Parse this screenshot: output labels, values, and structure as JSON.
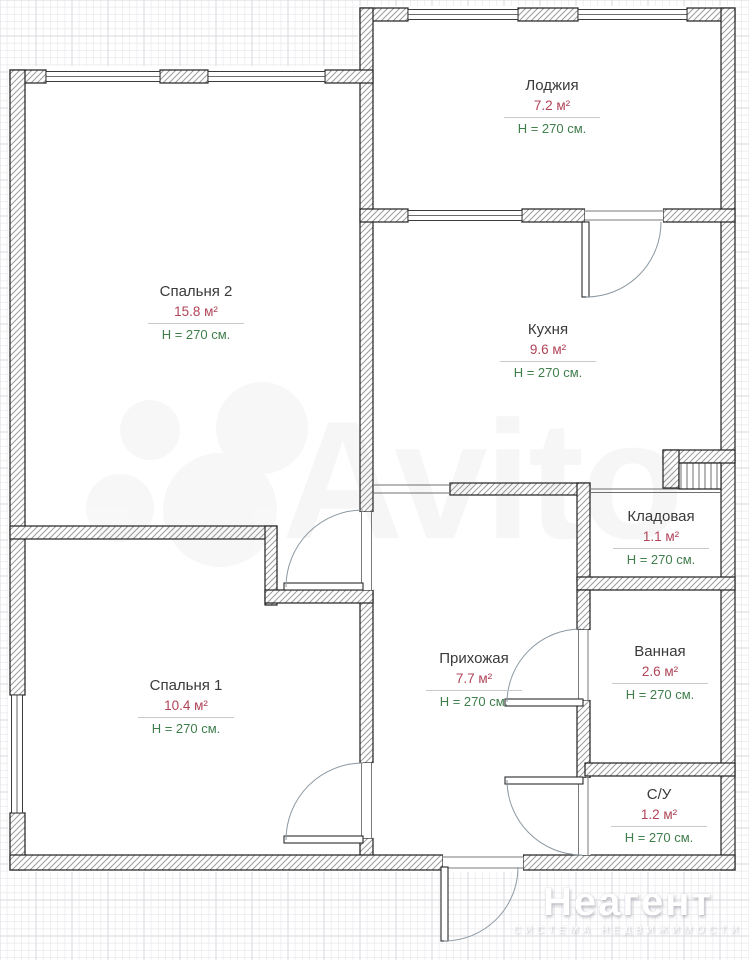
{
  "rooms": [
    {
      "id": "lodzhiya",
      "name": "Лоджия",
      "area": "7.2 м²",
      "height": "H = 270 см."
    },
    {
      "id": "spalnya2",
      "name": "Спальня 2",
      "area": "15.8 м²",
      "height": "H = 270 см."
    },
    {
      "id": "kuhnya",
      "name": "Кухня",
      "area": "9.6 м²",
      "height": "H = 270 см."
    },
    {
      "id": "kladovaya",
      "name": "Кладовая",
      "area": "1.1 м²",
      "height": "H = 270 см."
    },
    {
      "id": "prihozhaya",
      "name": "Прихожая",
      "area": "7.7 м²",
      "height": "H = 270 см."
    },
    {
      "id": "vannaya",
      "name": "Ванная",
      "area": "2.6 м²",
      "height": "H = 270 см."
    },
    {
      "id": "spalnya1",
      "name": "Спальня 1",
      "area": "10.4 м²",
      "height": "H = 270 см."
    },
    {
      "id": "su",
      "name": "С/У",
      "area": "1.2 м²",
      "height": "H = 270 см."
    }
  ],
  "watermarks": {
    "avito": "Avito",
    "agency_title": "Неагент",
    "agency_subtitle": "СИСТЕМА НЕДВИЖИМОСТИ"
  },
  "colors": {
    "room_name": "#3a3a3a",
    "area_value": "#b04458",
    "ceiling_height": "#3f7d4b",
    "wall_outline": "#1f1f1f",
    "door_arc": "#8a98a2"
  }
}
